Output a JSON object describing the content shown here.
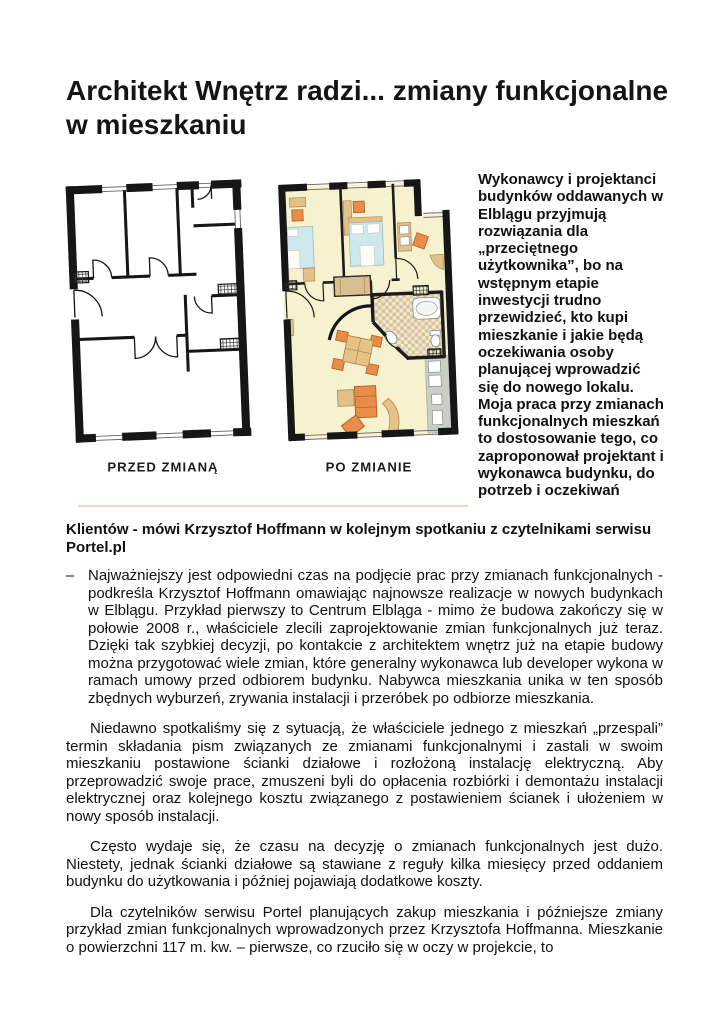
{
  "page": {
    "title": "Architekt Wnętrz radzi... zmiany funkcjonalne w mieszkaniu"
  },
  "figures": {
    "before": {
      "caption": "PRZED ZMIANĄ"
    },
    "after": {
      "caption": "PO ZMIANIE"
    }
  },
  "lead": {
    "side_text": "Wykonawcy i projektanci budynków oddawanych w Elblągu przyjmują rozwiązania dla „przeciętnego użytkownika”, bo na wstępnym etapie inwestycji trudno przewidzieć, kto kupi mieszkanie i jakie będą oczekiwania osoby planującej wprowadzić się do nowego lokalu. Moja praca przy zmianach funkcjonalnych mieszkań to dostosowanie tego, co zaproponował projektant i wykonawca budynku, do potrzeb i oczekiwań",
    "continuation": "Klientów - mówi Krzysztof Hoffmann w kolejnym spotkaniu z czytelnikami serwisu Portel.pl"
  },
  "body": {
    "bullet_char": "–",
    "paragraphs": [
      "Najważniejszy jest odpowiedni czas na podjęcie prac przy zmianach funkcjonalnych - podkreśla Krzysztof Hoffmann omawiając najnowsze realizacje w nowych budynkach w Elblągu. Przykład pierwszy to Centrum Elbląga - mimo że budowa zakończy się w połowie 2008 r., właściciele zlecili zaprojektowanie zmian funkcjonalnych już teraz. Dzięki tak szybkiej decyzji, po kontakcie z architektem wnętrz już na etapie budowy można przygotować wiele zmian, które generalny wykonawca lub developer wykona w ramach umowy przed odbiorem budynku. Nabywca mieszkania unika w ten sposób zbędnych wyburzeń, zrywania instalacji i przeróbek po odbiorze mieszkania.",
      "Niedawno spotkaliśmy się z sytuacją, że właściciele jednego z mieszkań „przespali” termin składania pism związanych ze zmianami funkcjonalnymi i zastali w swoim mieszkaniu postawione ścianki działowe i rozłożoną instalację elektryczną. Aby przeprowadzić swoje prace, zmuszeni byli do opłacenia rozbiórki i demontażu instalacji elektrycznej oraz kolejnego kosztu związanego z postawieniem ścianek i ułożeniem w nowy sposób instalacji.",
      "Często wydaje się, że czasu na decyzję o zmianach funkcjonalnych jest dużo. Niestety, jednak ścianki działowe są stawiane z reguły kilka miesięcy przed oddaniem budynku do użytkowania i później pojawiają dodatkowe koszty.",
      "Dla czytelników serwisu Portel planujących zakup mieszkania i późniejsze zmiany przykład zmian funkcjonalnych wprowadzonych przez Krzysztofa Hoffmanna. Mieszkanie o powierzchni 117 m. kw. – pierwsze, co rzuciło się w oczy w projekcie, to"
    ]
  },
  "colors": {
    "wall_black": "#161616",
    "divider_tan": "#ecd9bd",
    "floor_cream": "#f6f2cf",
    "furniture_orange": "#e98c4a",
    "bed_blue": "#cfe8ec",
    "wood_tan": "#e2c089",
    "tile_tan": "#d7c49c",
    "kitchen_gray": "#c9cfc7"
  }
}
